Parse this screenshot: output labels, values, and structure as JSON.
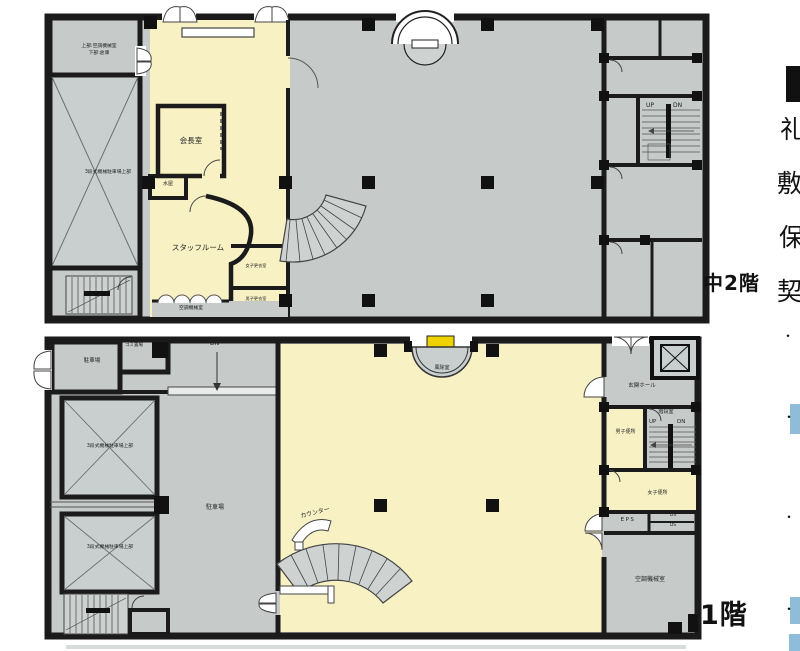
{
  "colors": {
    "floor_gray": "#c6cbca",
    "room_yellow": "#f7f1c4",
    "wall_black": "#1b1b1b",
    "entrance_mat_yellow": "#eed200",
    "highlight_blue": "#8fbcd9"
  },
  "mezzanine": {
    "floor_label": "中2階",
    "rooms": {
      "machine_room_upper_l1": "上部:空調機械室",
      "machine_room_upper_l2": "下部:倉庫",
      "mech_parking": "3段式機械駐車場上部",
      "chairman_room": "会長室",
      "mizuya": "水屋",
      "staff_room": "スタッフルーム",
      "womens_locker": "女子更衣室",
      "mens_locker": "男子更衣室",
      "hvac_room": "空調機械室"
    },
    "stairs": {
      "up": "UP",
      "down": "DN"
    }
  },
  "first_floor": {
    "floor_label": "1階",
    "rooms": {
      "parking_garage": "駐車場",
      "garbage_room": "ゴミ置場",
      "mech_parking_upper_1": "3段式機械駐車場上部",
      "mech_parking_upper_2": "3段式機械駐車場上部",
      "parking_area": "駐車場",
      "counter": "カウンター",
      "windbreak_room": "風除室",
      "entrance_hall": "玄関ホール",
      "stair_room": "階段室",
      "mens_toilet": "男子便所",
      "womens_toilet": "女子便所",
      "eps": "EPS",
      "ds_upper": "DS",
      "ds_lower": "DS",
      "hvac_room": "空調機械室"
    },
    "ramp_label": "DN",
    "stairs": {
      "up": "UP",
      "down": "DN"
    }
  },
  "side_text": {
    "clipped_chars": [
      "礼",
      "敷",
      "保",
      "契"
    ],
    "bullet": "・"
  }
}
